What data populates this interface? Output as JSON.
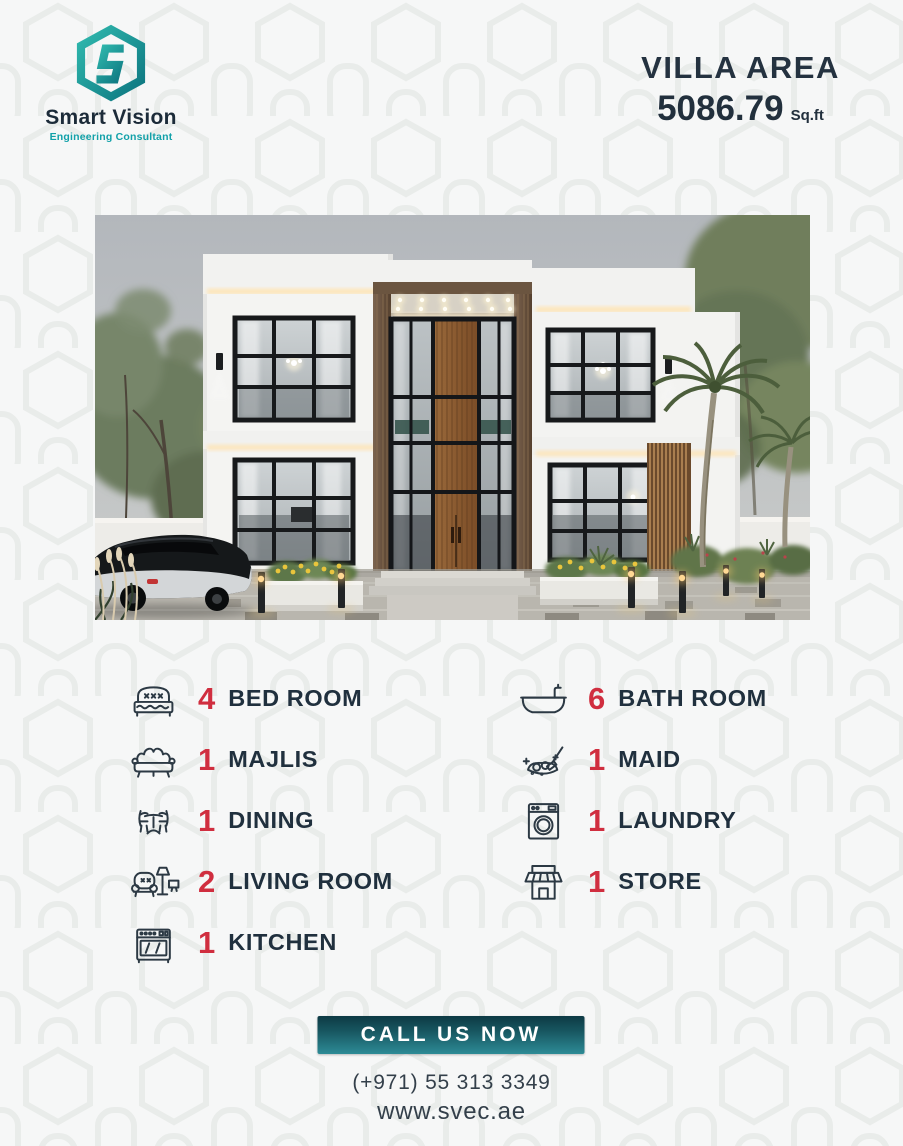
{
  "brand": {
    "name": "Smart Vision",
    "tagline": "Engineering Consultant"
  },
  "villa_area": {
    "title": "VILLA AREA",
    "value": "5086.79",
    "unit": "Sq.ft"
  },
  "features": [
    {
      "icon": "bed-icon",
      "count": "4",
      "label": "BED ROOM",
      "column": "left"
    },
    {
      "icon": "majlis-sofa-icon",
      "count": "1",
      "label": "MAJLIS",
      "column": "left"
    },
    {
      "icon": "dining-table-icon",
      "count": "1",
      "label": "DINING",
      "column": "left"
    },
    {
      "icon": "living-room-icon",
      "count": "2",
      "label": "LIVING ROOM",
      "column": "left"
    },
    {
      "icon": "kitchen-stove-icon",
      "count": "1",
      "label": "KITCHEN",
      "column": "left"
    },
    {
      "icon": "bathtub-icon",
      "count": "6",
      "label": "BATH ROOM",
      "column": "right"
    },
    {
      "icon": "maid-cleaning-icon",
      "count": "1",
      "label": "MAID",
      "column": "right"
    },
    {
      "icon": "washing-machine-icon",
      "count": "1",
      "label": "LAUNDRY",
      "column": "right"
    },
    {
      "icon": "storefront-icon",
      "count": "1",
      "label": "STORE",
      "column": "right"
    }
  ],
  "cta": {
    "button_label": "CALL US NOW",
    "phone": "(+971) 55 313 3349",
    "website": "www.svec.ae"
  },
  "colors": {
    "accent_red": "#d02e3f",
    "navy_text": "#20303e",
    "teal_brand": "#12a1a9",
    "button_gradient_top": "#0d3a44",
    "button_gradient_bottom": "#2d8b96",
    "page_background": "#f6f7f7"
  }
}
